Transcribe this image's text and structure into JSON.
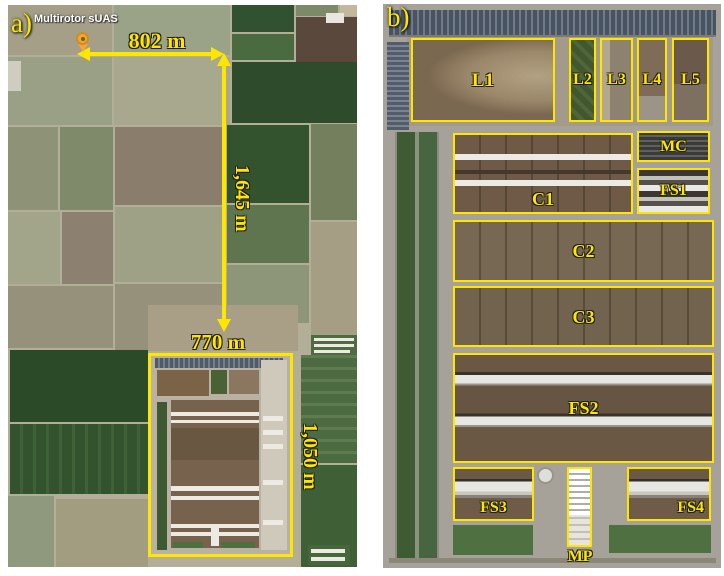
{
  "colors": {
    "annotation_yellow": "#ffe600",
    "marker_pin_orange": "#f2a63a",
    "uas_text_white": "#ffffff",
    "solar_array_slate": "#495462"
  },
  "panel_a": {
    "label": "a)",
    "uas_marker_label": "Multirotor sUAS",
    "measurements": {
      "top_width": "802 m",
      "vertical_distance": "1,645 m",
      "site_width": "770 m",
      "site_height": "1,050 m"
    }
  },
  "panel_b": {
    "label": "b)",
    "regions": {
      "l1": "L1",
      "l2": "L2",
      "l3": "L3",
      "l4": "L4",
      "l5": "L5",
      "mc": "MC",
      "fs1": "FS1",
      "c1": "C1",
      "c2": "C2",
      "c3": "C3",
      "fs2": "FS2",
      "fs3": "FS3",
      "fs4": "FS4",
      "mp": "MP"
    }
  }
}
